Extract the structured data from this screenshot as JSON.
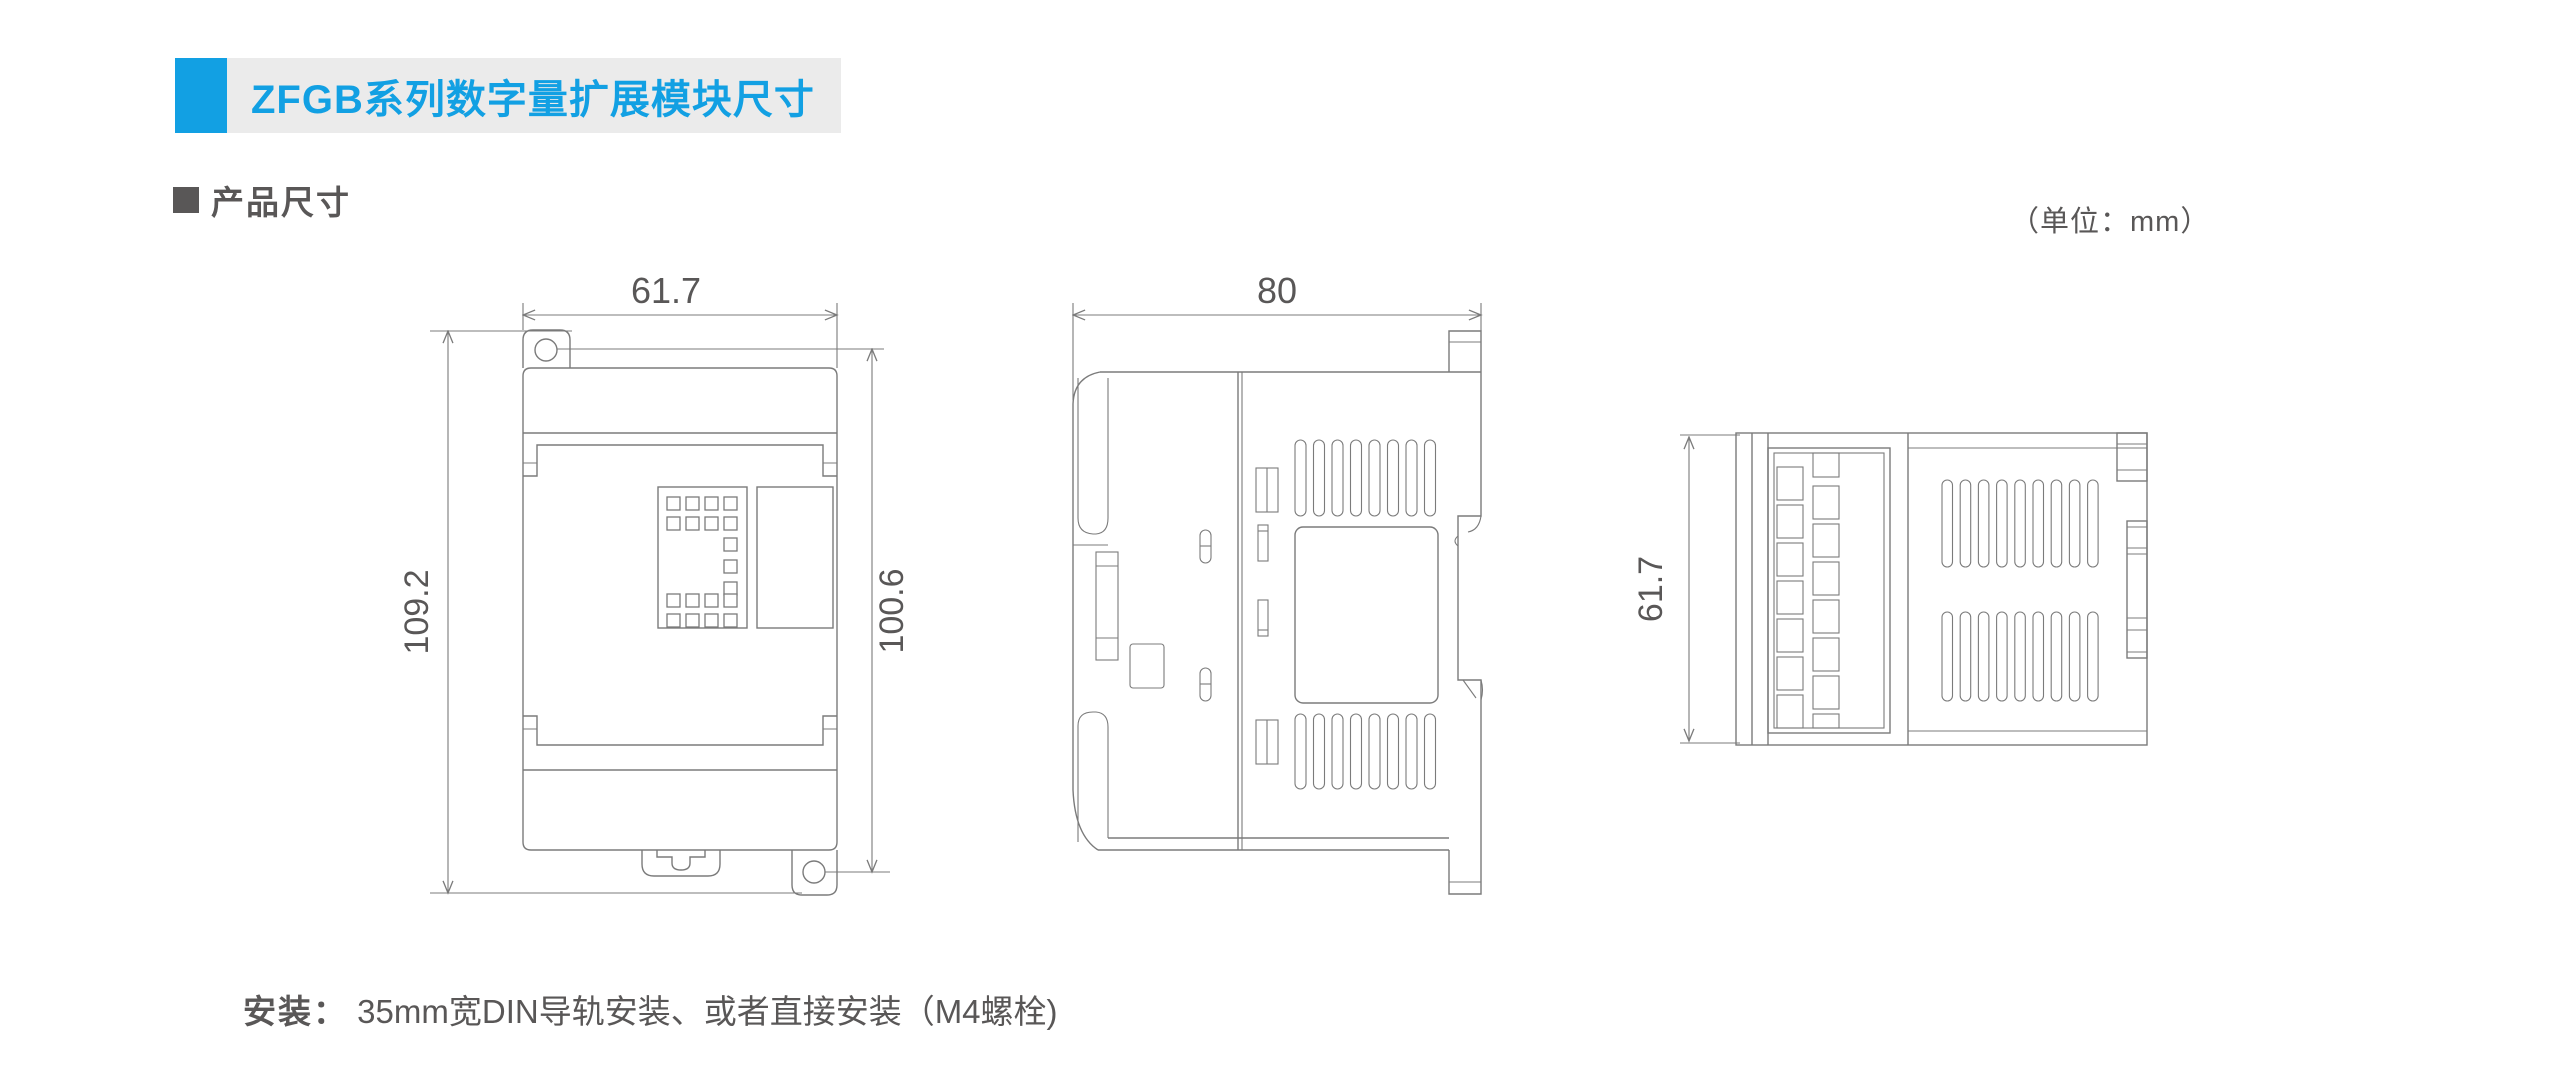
{
  "header": {
    "title": "ZFGB系列数字量扩展模块尺寸",
    "accent_color": "#12a0e3",
    "bar_color": "#ebebeb"
  },
  "section": {
    "title": "产品尺寸",
    "unit_note": "（单位：mm）"
  },
  "views": {
    "front": {
      "width_label": "61.7",
      "overall_height_label": "109.2",
      "mount_height_label": "100.6"
    },
    "side": {
      "depth_label": "80"
    },
    "end": {
      "height_label": "61.7"
    }
  },
  "footer": {
    "label": "安装：",
    "text": "35mm宽DIN导轨安装、或者直接安装（M4螺栓)"
  },
  "colors": {
    "line": "#7b7b7b",
    "text": "#595757"
  }
}
